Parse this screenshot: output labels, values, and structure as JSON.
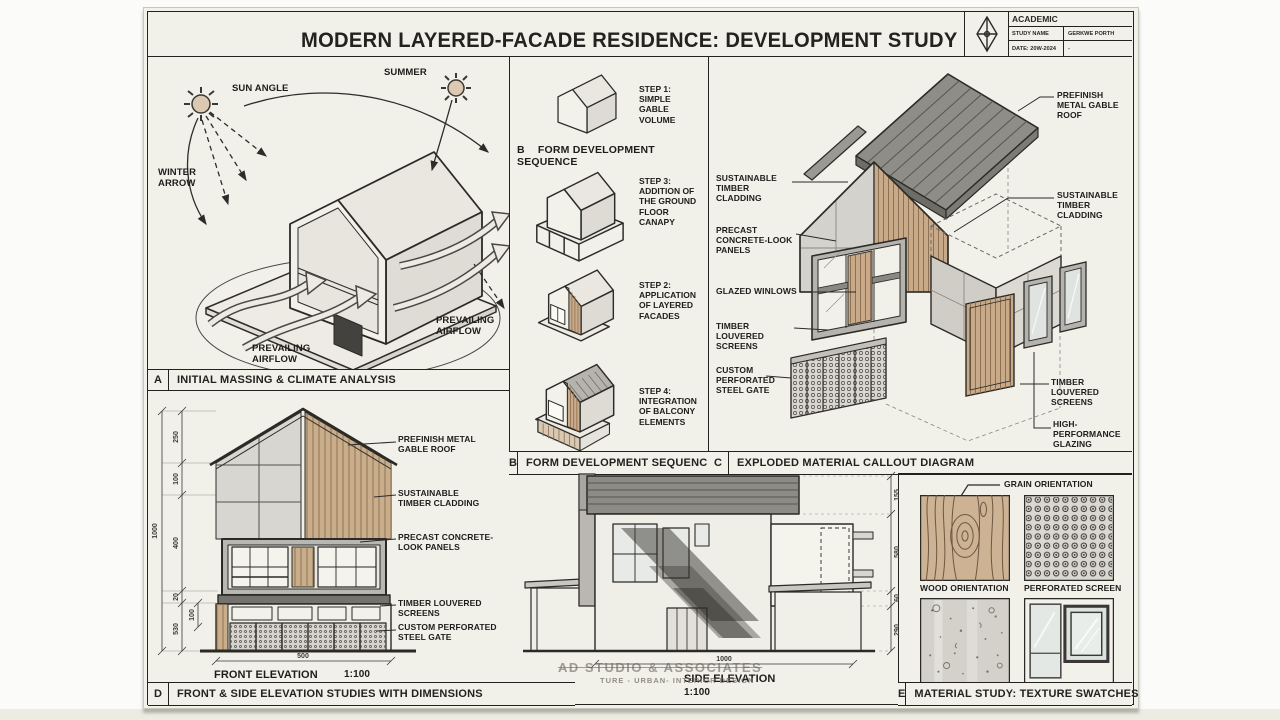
{
  "sheet": {
    "title": "MODERN LAYERED-FACADE RESIDENCE: DEVELOPMENT STUDY",
    "title_block": {
      "category": "ACADEMIC",
      "study_name_label": "STUDY NAME",
      "study_name_value": "GERKWE PORTH",
      "date_label": "DATE: 20W-2024",
      "date_value": "-"
    },
    "watermark_line1": "AD STUDIO & ASSOCIATES",
    "watermark_line2": "TURE - URBAN- INTERIOR DESIGN"
  },
  "colors": {
    "paper": "#f1f0e9",
    "ink": "#23221f",
    "timber": "#c8aa88",
    "roof_gray": "#8f8d87",
    "concrete_gray": "#d4d2cb"
  },
  "panel_a": {
    "letter": "A",
    "caption": "INITIAL MASSING & CLIMATE ANALYSIS",
    "label_sun_angle": "SUN ANGLE",
    "label_summer": "SUMMER",
    "label_winter_arrow": "WINTER ARROW",
    "label_airflow_left": "PREVAILING AIRFLOW",
    "label_airflow_right": "PREVAILING AIRFLOW"
  },
  "panel_b": {
    "letter": "B",
    "caption": "FORM DEVELOPMENT SEQUENCE",
    "heading_letter": "B",
    "heading_text": "FORM DEVELOPMENT SEQUENCE",
    "steps": [
      {
        "no": "STEP 1:",
        "desc": "SIMPLE GABLE VOLUME"
      },
      {
        "no": "STEP 3:",
        "desc": "ADDITION OF THE GROUND FLOOR CANAPY"
      },
      {
        "no": "STEP 2:",
        "desc": "APPLICATION OF LAYERED FACADES"
      },
      {
        "no": "STEP 4:",
        "desc": "INTEGRATION OF BALCONY ELEMENTS"
      }
    ]
  },
  "panel_c": {
    "letter": "C",
    "caption": "EXPLODED MATERIAL CALLOUT DIAGRAM",
    "left_labels": [
      "SUSTAINABLE TIMBER CLADDING",
      "PRECAST CONCRETE-LOOK PANELS",
      "GLAZED WINLOWS",
      "TIMBER LOUVERED SCREENS",
      "CUSTOM PERFORATED STEEL GATE"
    ],
    "right_labels": [
      "PREFINISH METAL GABLE ROOF",
      "SUSTAINABLE TIMBER CLADDING",
      "TIMBER LOUVERED SCREENS",
      "HIGH-PERFORMANCE GLAZING"
    ]
  },
  "panel_d": {
    "letter": "D",
    "caption": "FRONT & SIDE ELEVATION STUDIES WITH DIMENSIONS",
    "front": {
      "title": "FRONT ELEVATION",
      "scale": "1:100",
      "dim_total": "1000",
      "dims": [
        "250",
        "100",
        "400",
        "20",
        "530"
      ],
      "dim_sub": "100",
      "dim_width": "500",
      "callouts": [
        "PREFINISH METAL GABLE ROOF",
        "SUSTAINABLE TIMBER CLADDING",
        "PRECAST CONCRETE-LOOK PANELS",
        "TIMBER LOUVERED SCREENS",
        "CUSTOM PERFORATED STEEL GATE"
      ]
    },
    "side": {
      "title": "SIDE ELEVATION",
      "scale": "1:100",
      "dims": [
        "155",
        "580",
        "60",
        "290"
      ],
      "dim_width": "1000"
    }
  },
  "panel_e": {
    "letter": "E",
    "caption": "MATERIAL STUDY: TEXTURE SWATCHES",
    "grain_label": "GRAIN ORIENTATION",
    "swatch_labels": [
      "WOOD ORIENTATION",
      "PERFORATED SCREEN",
      "CONCRETE PANEL",
      "GLASS TEXTURE"
    ]
  }
}
